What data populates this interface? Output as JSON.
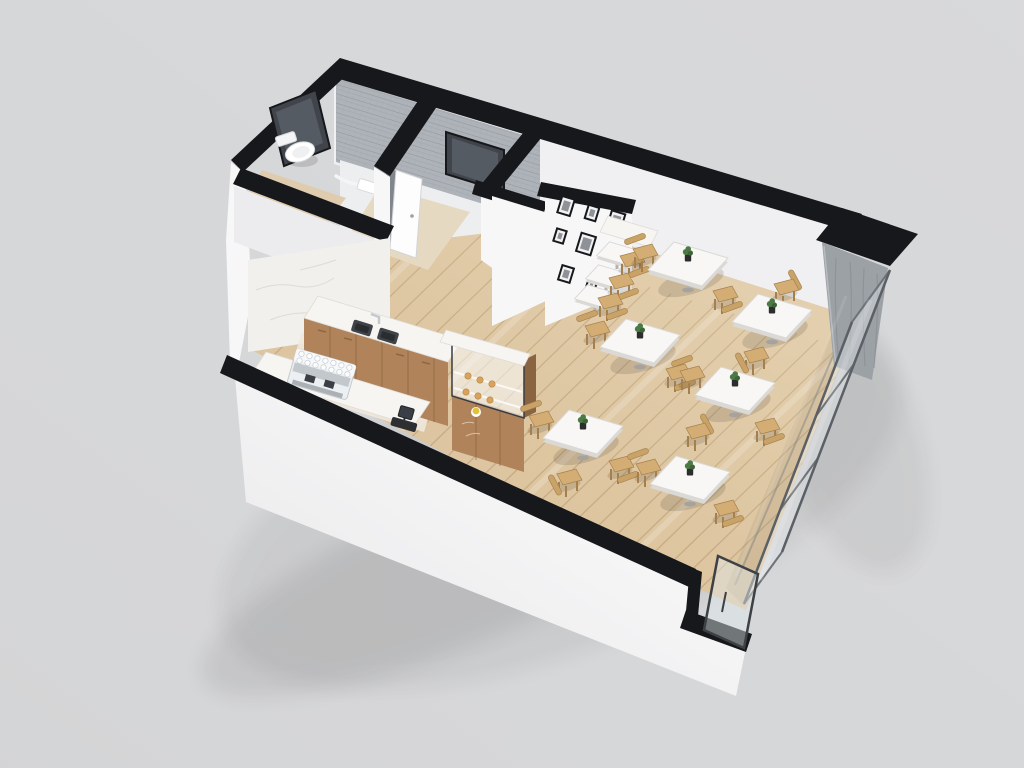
{
  "scene": {
    "type": "3d-floorplan-render",
    "subject": "cafe floor plan dollhouse cutaway view",
    "view": "axonometric from above, walls cut with black caps",
    "background": "#d6d7d9"
  },
  "palette": {
    "cap": "#17181b",
    "wall": "#f7f7f8",
    "wall_dim": "#ececee",
    "ne_face": "#f0f0f2",
    "room_fill": "#edeef0",
    "tile": "#aeb3b9",
    "tile_line": "#91979e",
    "mirror": "#41454b",
    "mirror_inner": "#5c636b",
    "marble": "#f2f0ec",
    "marble_vein": "#d9d5cf",
    "floor": "#dcc49e",
    "plank": "rgba(146,108,66,0.30)",
    "streak": "rgba(255,255,255,0.20)",
    "corridor_floor": "#e6d9c2",
    "bath_floor": "#dfccae",
    "counter": "#f6f5f2",
    "counter_edge": "#dfdcd6",
    "cabinet": "#b0835a",
    "cabinet_dark": "#8d6743",
    "cabinet_line": "#7c5a39",
    "table_top": "#f8f7f5",
    "table_edge": "#dbd9d5",
    "leg_metal": "#b5b3b0",
    "chair": "#d4ad74",
    "chair_dark": "#a5804c",
    "chair_back": "#c9a267",
    "glass": "rgba(233,238,242,0.38)",
    "glass_frame": "#5b6066",
    "mullion": "#6e7379",
    "concrete": "#9ca1a6",
    "concrete_line": "#858a8f",
    "espresso": "#edf0f2",
    "steel": "#c3c8cd",
    "dark_fixture": "#2d2f33",
    "sink": "#3f4347",
    "plant": "#4c7a44",
    "plant_dark": "#3c6434",
    "pot": "#2c2d2f",
    "pastry": "#d8a35c",
    "pastry_yellow": "#e4c238",
    "shadow": "rgba(40,34,26,0.14)",
    "door_gap": "#81868d",
    "frame_black": "#17181b",
    "frame_mat": "#f2f2f3",
    "photo": "#8e9298"
  },
  "architecture": {
    "rooms": [
      "dining-area",
      "kitchen",
      "accessible-restroom",
      "corridor",
      "back-room",
      "storage-room"
    ],
    "features": [
      "black-cut-wall-caps",
      "glass-storefront-wall",
      "concrete-column",
      "wood-plank-floor"
    ],
    "doors": [
      {
        "name": "restroom-door",
        "state": "ajar"
      },
      {
        "name": "back-room-door",
        "state": "open"
      },
      {
        "name": "entry-glass-door",
        "state": "closed"
      }
    ],
    "glass_panels": 3
  },
  "restroom": {
    "fixtures": [
      "toilet",
      "grab-bar",
      "wall-mirror",
      "wall-sink"
    ]
  },
  "kitchen": {
    "fixtures": [
      "espresso-machine",
      "double-basin-sink",
      "faucet",
      "cash-register",
      "pastry-display-case",
      "back-counter",
      "front-counter",
      "wood-cabinets",
      "marble-backsplash-wall"
    ],
    "pastry_items": {
      "croissants": 6,
      "yellow_cake": 1
    }
  },
  "furniture": {
    "dining_tables": [
      {
        "id": 1,
        "x": 688,
        "y": 264,
        "plant": true,
        "chairs": [
          {
            "dx": -45,
            "dy": -11,
            "side": "nw"
          },
          {
            "dx": 35,
            "dy": 31,
            "side": "se"
          }
        ]
      },
      {
        "id": 2,
        "x": 772,
        "y": 316,
        "plant": true,
        "chairs": [
          {
            "dx": 12,
            "dy": -28,
            "side": "ne"
          },
          {
            "dx": -18,
            "dy": 40,
            "side": "sw"
          }
        ]
      },
      {
        "id": 3,
        "x": 640,
        "y": 341,
        "plant": true,
        "chairs": [
          {
            "dx": -45,
            "dy": -11,
            "side": "nw"
          },
          {
            "dx": 36,
            "dy": 32,
            "side": "se"
          }
        ]
      },
      {
        "id": 4,
        "x": 735,
        "y": 389,
        "plant": true,
        "chairs": [
          {
            "dx": -45,
            "dy": -14,
            "side": "nw"
          },
          {
            "dx": 30,
            "dy": 38,
            "side": "se"
          }
        ]
      },
      {
        "id": 5,
        "x": 583,
        "y": 432,
        "plant": true,
        "chairs": [
          {
            "dx": -44,
            "dy": -12,
            "side": "nw"
          },
          {
            "dx": 36,
            "dy": 33,
            "side": "se"
          },
          {
            "dx": -16,
            "dy": 46,
            "side": "sw"
          }
        ]
      },
      {
        "id": 6,
        "x": 690,
        "y": 478,
        "plant": true,
        "chairs": [
          {
            "dx": -44,
            "dy": -10,
            "side": "nw"
          },
          {
            "dx": 34,
            "dy": 31,
            "side": "se"
          },
          {
            "dx": 6,
            "dy": -46,
            "side": "ne"
          }
        ]
      }
    ],
    "wall_bar": {
      "tables": [
        {
          "x": 617,
          "y": 253
        },
        {
          "x": 606,
          "y": 276
        },
        {
          "x": 595,
          "y": 296
        }
      ],
      "stools": [
        {
          "x": 630,
          "y": 260
        },
        {
          "x": 619,
          "y": 282
        },
        {
          "x": 608,
          "y": 302
        }
      ]
    },
    "plants_on_tables": 6
  },
  "decor": {
    "picture_frames": [
      {
        "x": 566,
        "y": 206,
        "w": 15,
        "h": 19
      },
      {
        "x": 592,
        "y": 213,
        "w": 13,
        "h": 16
      },
      {
        "x": 616,
        "y": 221,
        "w": 16,
        "h": 20
      },
      {
        "x": 560,
        "y": 236,
        "w": 12,
        "h": 15
      },
      {
        "x": 586,
        "y": 244,
        "w": 17,
        "h": 21
      },
      {
        "x": 612,
        "y": 252,
        "w": 12,
        "h": 15
      },
      {
        "x": 566,
        "y": 274,
        "w": 14,
        "h": 17
      },
      {
        "x": 592,
        "y": 283,
        "w": 11,
        "h": 14
      }
    ]
  }
}
